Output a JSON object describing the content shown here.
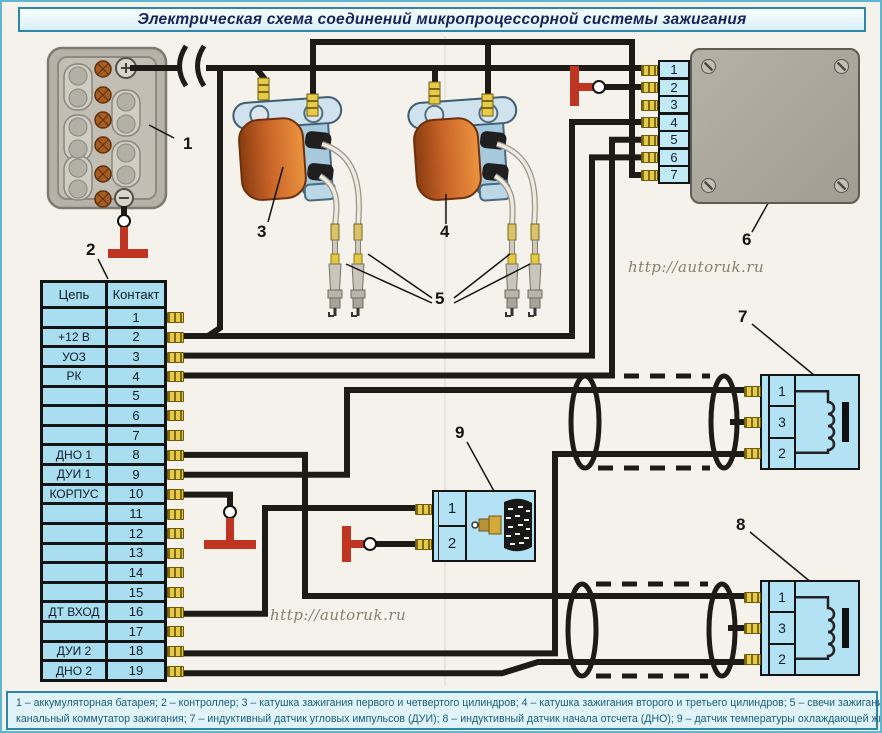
{
  "title": "Электрическая схема соединений микропроцессорной системы зажигания",
  "watermark": "http://autoruk.ru",
  "caption": {
    "line1": "1 – аккумуляторная батарея; 2 – контроллер; 3 – катушка зажигания первого и четвертого цилиндров; 4 – катушка зажигания второго и третьего цилиндров; 5 – свечи зажигания; 6 – двух-",
    "line2": "канальный коммутатор зажигания; 7 – индуктивный датчик угловых импульсов (ДУИ); 8 – индуктивный датчик начала отсчета (ДНО); 9 – датчик температуры охлаждающей жидкости (ДТ)"
  },
  "connector_table": {
    "headers": [
      "Цепь",
      "Контакт"
    ],
    "rows": [
      {
        "circuit": "",
        "contact": "1"
      },
      {
        "circuit": "+12 В",
        "contact": "2"
      },
      {
        "circuit": "УОЗ",
        "contact": "3"
      },
      {
        "circuit": "РК",
        "contact": "4"
      },
      {
        "circuit": "",
        "contact": "5"
      },
      {
        "circuit": "",
        "contact": "6"
      },
      {
        "circuit": "",
        "contact": "7"
      },
      {
        "circuit": "ДНО 1",
        "contact": "8"
      },
      {
        "circuit": "ДУИ 1",
        "contact": "9"
      },
      {
        "circuit": "КОРПУС",
        "contact": "10"
      },
      {
        "circuit": "",
        "contact": "11"
      },
      {
        "circuit": "",
        "contact": "12"
      },
      {
        "circuit": "",
        "contact": "13"
      },
      {
        "circuit": "",
        "contact": "14"
      },
      {
        "circuit": "",
        "contact": "15"
      },
      {
        "circuit": "ДТ ВХОД",
        "contact": "16"
      },
      {
        "circuit": "",
        "contact": "17"
      },
      {
        "circuit": "ДУИ 2",
        "contact": "18"
      },
      {
        "circuit": "ДНО 2",
        "contact": "19"
      }
    ]
  },
  "commutator": {
    "contacts": [
      "1",
      "2",
      "3",
      "4",
      "5",
      "6",
      "7"
    ]
  },
  "sensor_dui": {
    "contacts": [
      "1",
      "3",
      "2"
    ]
  },
  "sensor_dno": {
    "contacts": [
      "1",
      "3",
      "2"
    ]
  },
  "sensor_temp": {
    "contacts": [
      "1",
      "2"
    ]
  },
  "labels": {
    "battery": "1",
    "controller": "2",
    "coil_1_4": "3",
    "coil_2_3": "4",
    "spark_plugs": "5",
    "commutator": "6",
    "sensor_dui": "7",
    "sensor_dno": "8",
    "sensor_temp": "9"
  },
  "colors": {
    "wire": "#1e1b17",
    "ground_red": "#c03522",
    "cell_blue": "#a9def0",
    "box_gray": "#aba79d",
    "pin_yellow": "#e6ca48",
    "frame_teal": "#2e87a6"
  }
}
